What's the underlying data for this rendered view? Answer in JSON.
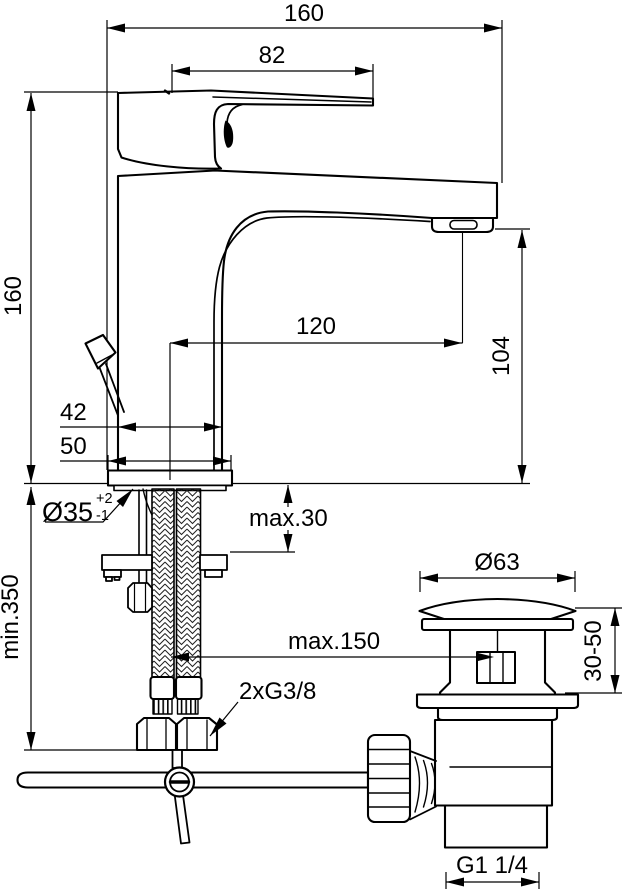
{
  "drawing": {
    "background": "#ffffff",
    "line_color": "#000000",
    "type": "faucet-installation-dimension-drawing",
    "dimensions": {
      "total_width": "160",
      "handle_length": "82",
      "body_height": "160",
      "spout_reach": "120",
      "spout_outlet_height": "104",
      "upper_body_width": "42",
      "base_width": "50",
      "mounting_hole": {
        "dia": "Ø35",
        "tol_plus": "+2",
        "tol_minus": "-1"
      },
      "deck_thickness": "max.30",
      "clearance_below": "min.350",
      "waste_flange_dia": "Ø63",
      "hose_offset": "max.150",
      "waste_deck_range": "30-50",
      "supply_thread": "2xG3/8",
      "waste_thread": "G1 1/4"
    }
  }
}
